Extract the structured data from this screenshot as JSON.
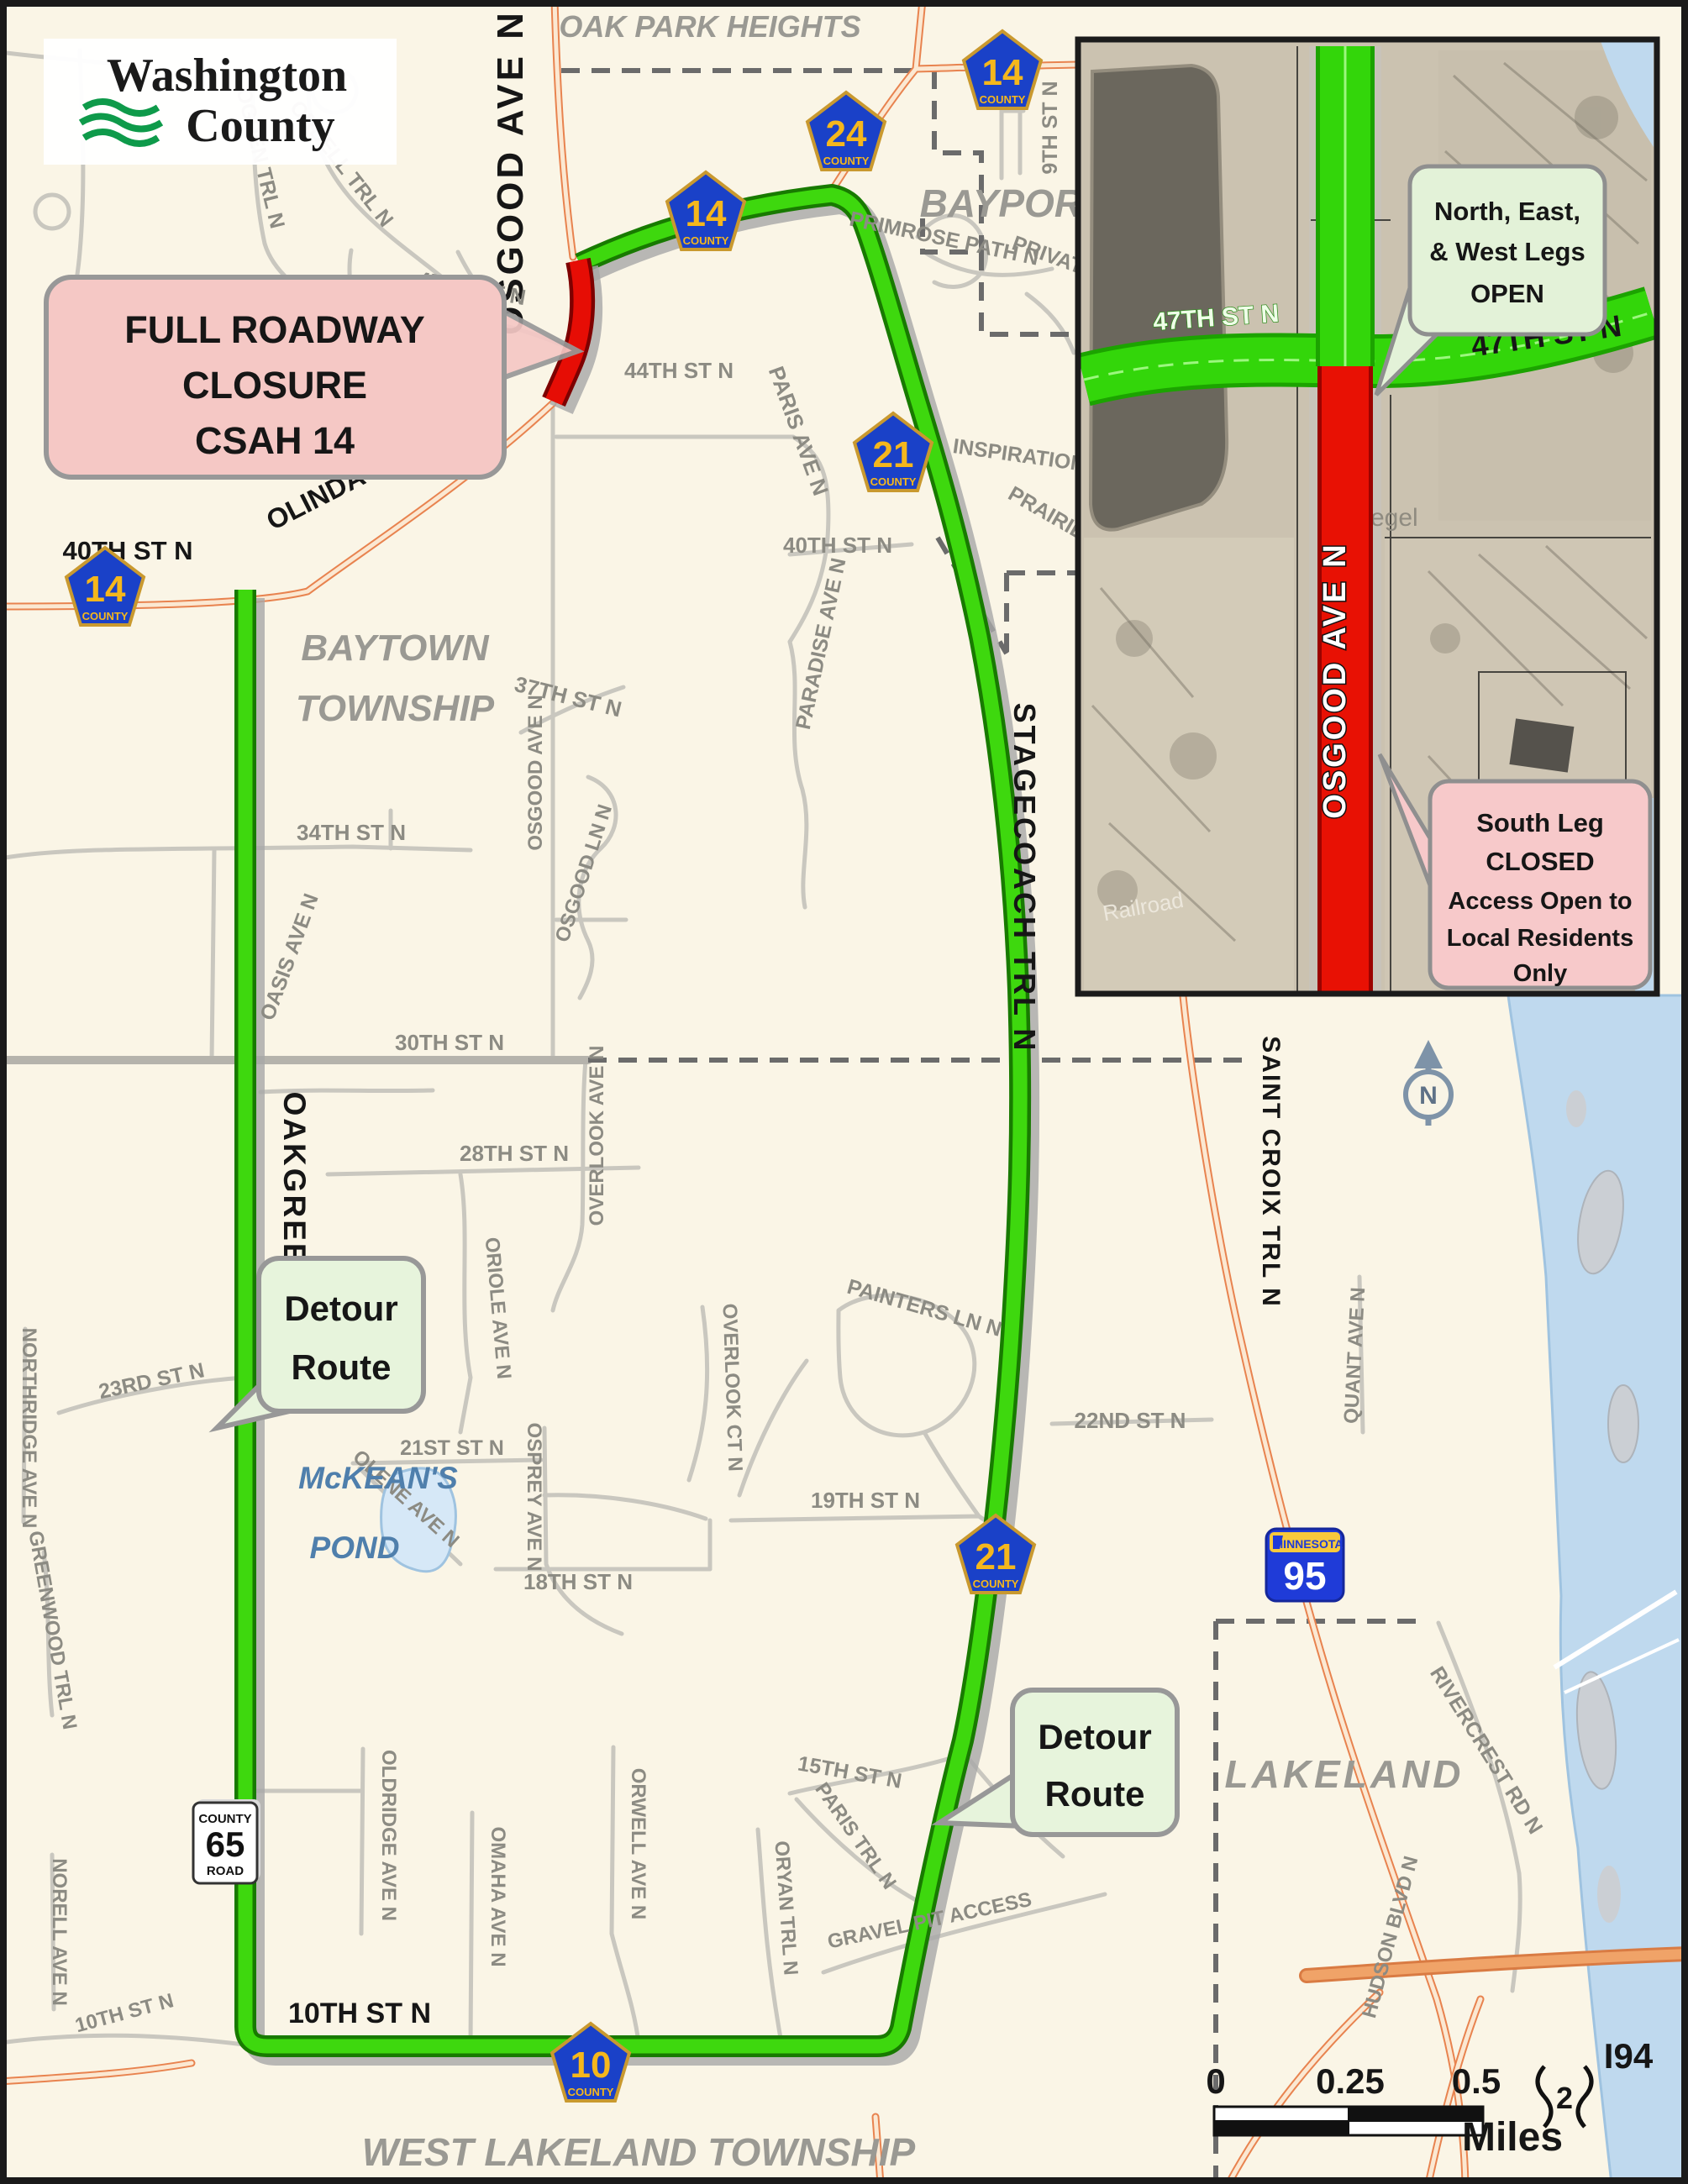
{
  "logo": {
    "line1": "Washington",
    "line2": "County"
  },
  "callouts": {
    "closure": {
      "l1": "FULL ROADWAY",
      "l2": "CLOSURE",
      "l3": "CSAH 14"
    },
    "detour": {
      "l1": "Detour",
      "l2": "Route"
    },
    "open_legs": {
      "l1": "North, East,",
      "l2": "& West Legs",
      "l3": "OPEN"
    },
    "closed_leg": {
      "l1": "South Leg",
      "l2": "CLOSED",
      "l3": "Access Open to",
      "l4": "Local Residents",
      "l5": "Only"
    }
  },
  "places": {
    "oak_park_heights": "OAK PARK HEIGHTS",
    "bayport": "BAYPORT",
    "baytown_1": "BAYTOWN",
    "baytown_2": "TOWNSHIP",
    "west_lakeland": "WEST LAKELAND TOWNSHIP",
    "lakeland": "LAKELAND",
    "mckeans_1": "McKEAN'S",
    "mckeans_2": "POND"
  },
  "shields": {
    "c14": "14",
    "c21": "21",
    "c24": "24",
    "c10": "10",
    "county": "COUNTY",
    "c65_top": "COUNTY",
    "c65_num": "65",
    "c65_bot": "ROAD",
    "mn95_state": "MINNESOTA",
    "mn95_num": "95",
    "i94": "I94",
    "ramp": "2"
  },
  "streets": {
    "osgood_top": "OSGOOD AVE N",
    "ordell": "ORDELL TRL N",
    "ogden": "OGDEN TRL N",
    "st47": "47TH ST N",
    "st44": "44TH ST N",
    "st9": "9TH ST N",
    "primrose": "PRIMROSE PATH N",
    "private_rd": "PRIVATE",
    "inspiration": "INSPIRATION",
    "prairie": "PRAIRIE",
    "paris_ave": "PARIS AVE N",
    "st40_e": "40TH ST N",
    "paradise": "PARADISE AVE N",
    "olinda": "OLINDA BLVD N",
    "st40_w": "40TH ST N",
    "osgood_mid": "OSGOOD AVE N",
    "st37": "37TH ST N",
    "osgood_ln": "OSGOOD LN N",
    "st34": "34TH ST N",
    "oasis": "OASIS AVE N",
    "st30": "30TH ST N",
    "stagecoach": "STAGECOACH TRL N",
    "st28": "28TH ST N",
    "overlook_ave": "OVERLOOK AVE N",
    "overlook_ct": "OVERLOOK CT N",
    "oriole": "ORIOLE AVE N",
    "st23": "23RD ST N",
    "northridge": "NORTHRIDGE AVE N",
    "oakgreen": "OAKGREEN AVE N",
    "st21": "21ST ST N",
    "olene": "OLENE AVE N",
    "osprey": "OSPREY AVE N",
    "painters": "PAINTERS LN N",
    "st19": "19TH ST N",
    "st18": "18TH ST N",
    "st22": "22ND ST N",
    "greenwood": "GREENWOOD TRL N",
    "oldridge": "OLDRIDGE AVE N",
    "omaha": "OMAHA AVE N",
    "orwell": "ORWELL AVE N",
    "oryan": "ORYAN TRL N",
    "paris_trl": "PARIS TRL N",
    "st15": "15TH ST N",
    "st10": "10TH ST N",
    "st10_w": "10TH ST N",
    "norell": "NORELL AVE N",
    "gravel": "GRAVEL PIT ACCESS",
    "saint_croix": "SAINT CROIX TRL N",
    "quant": "QUANT AVE N",
    "rivercrest": "RIVERCREST RD N",
    "hudson": "HUDSON BLVD N"
  },
  "inset": {
    "st47_left": "47TH ST N",
    "st47_right": "47TH ST N",
    "osgood": "OSGOOD AVE N",
    "siegel": "Siegel",
    "railroad": "Railroad"
  },
  "scalebar": {
    "zero": "0",
    "quarter": "0.25",
    "half": "0.5",
    "unit": "Miles"
  },
  "north": "N",
  "colors": {
    "detour_green": "#3ED80E",
    "closure_red": "#E60D05",
    "highway_orange": "#E8834F",
    "water_blue": "#BFD9EE",
    "background_cream": "#FAF5E6"
  }
}
